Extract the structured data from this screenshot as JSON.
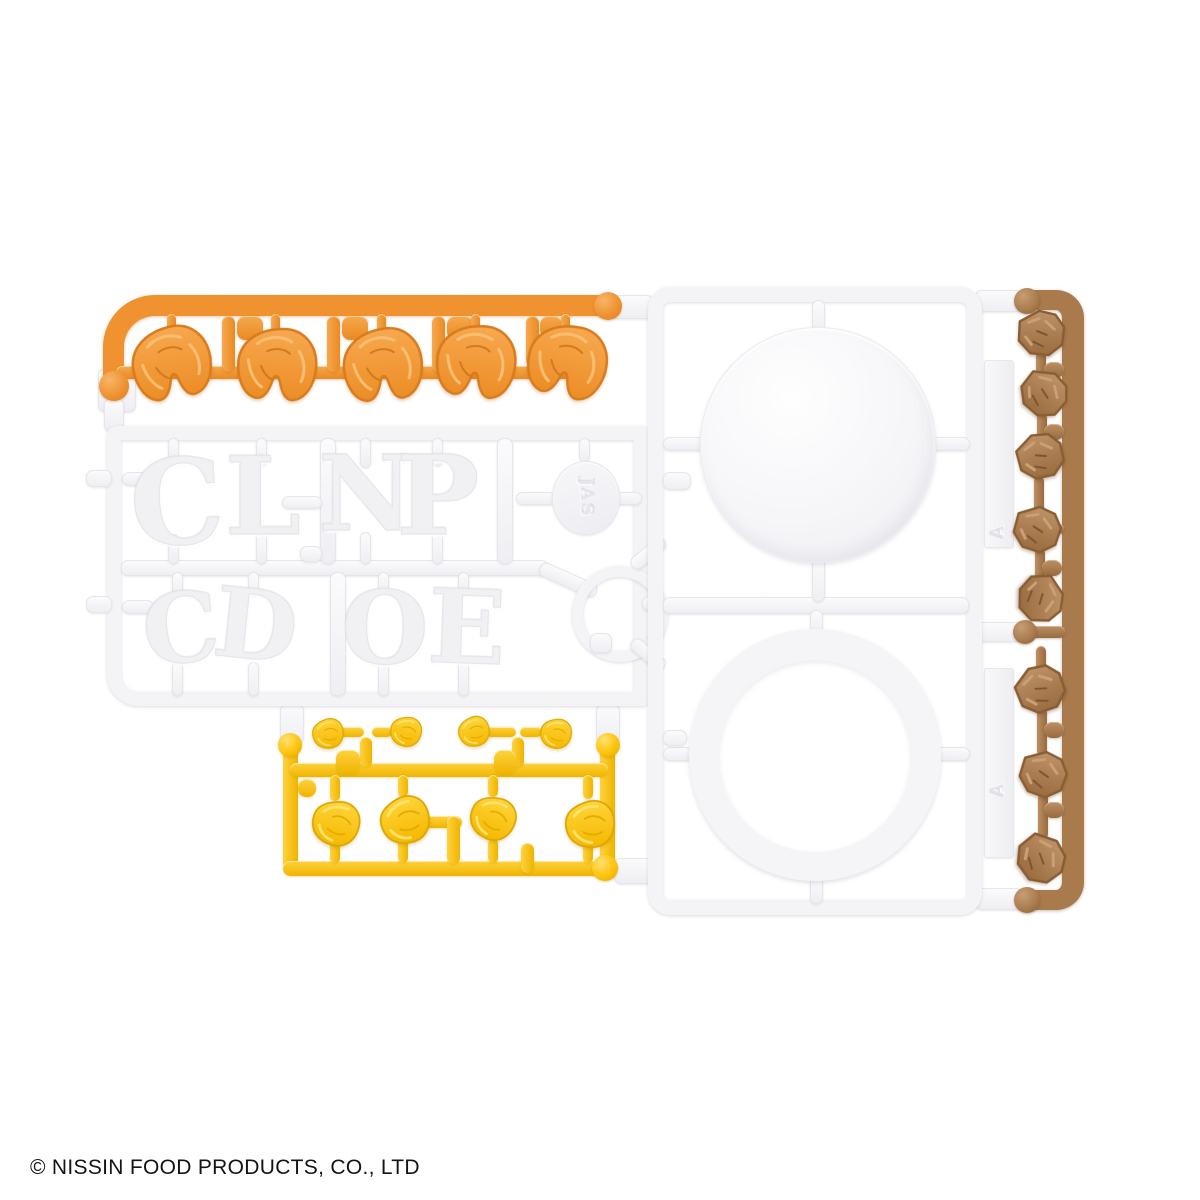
{
  "scene": {
    "description": "Product photo of plastic model-kit runner sprues (cup noodle model kit): orange shrimp runner, white logo-letter runner, yellow egg runner, white cup-lid runner and brown meat runner on a white background",
    "background_color": "#ffffff"
  },
  "footer": {
    "copyright": "© NISSIN FOOD PRODUCTS, CO., LTD"
  },
  "colors": {
    "shrimp_orange": "#F0922F",
    "egg_yellow": "#FFC30B",
    "meat_brown": "#A87A4C",
    "plastic_white": "#F4F4F7"
  },
  "runners": {
    "shrimp": {
      "label": "Shrimp pieces runner (orange)",
      "piece_count": 5
    },
    "letters": {
      "label": "Logo letters runner (white)",
      "top_row": [
        "C",
        "L",
        "N",
        "P"
      ],
      "bottom_row": [
        "C",
        "D",
        "O",
        "E"
      ],
      "badge_text": "JAS"
    },
    "egg": {
      "label": "Scrambled egg pieces runner (yellow)",
      "small_piece_count": 4,
      "large_piece_count": 4
    },
    "lid": {
      "label": "Cup lid runner (white)",
      "plate_marking": "A",
      "parts": [
        "lid disc",
        "rim ring"
      ]
    },
    "meat": {
      "label": "Meat chunk runner (brown)",
      "piece_count": 8
    }
  }
}
